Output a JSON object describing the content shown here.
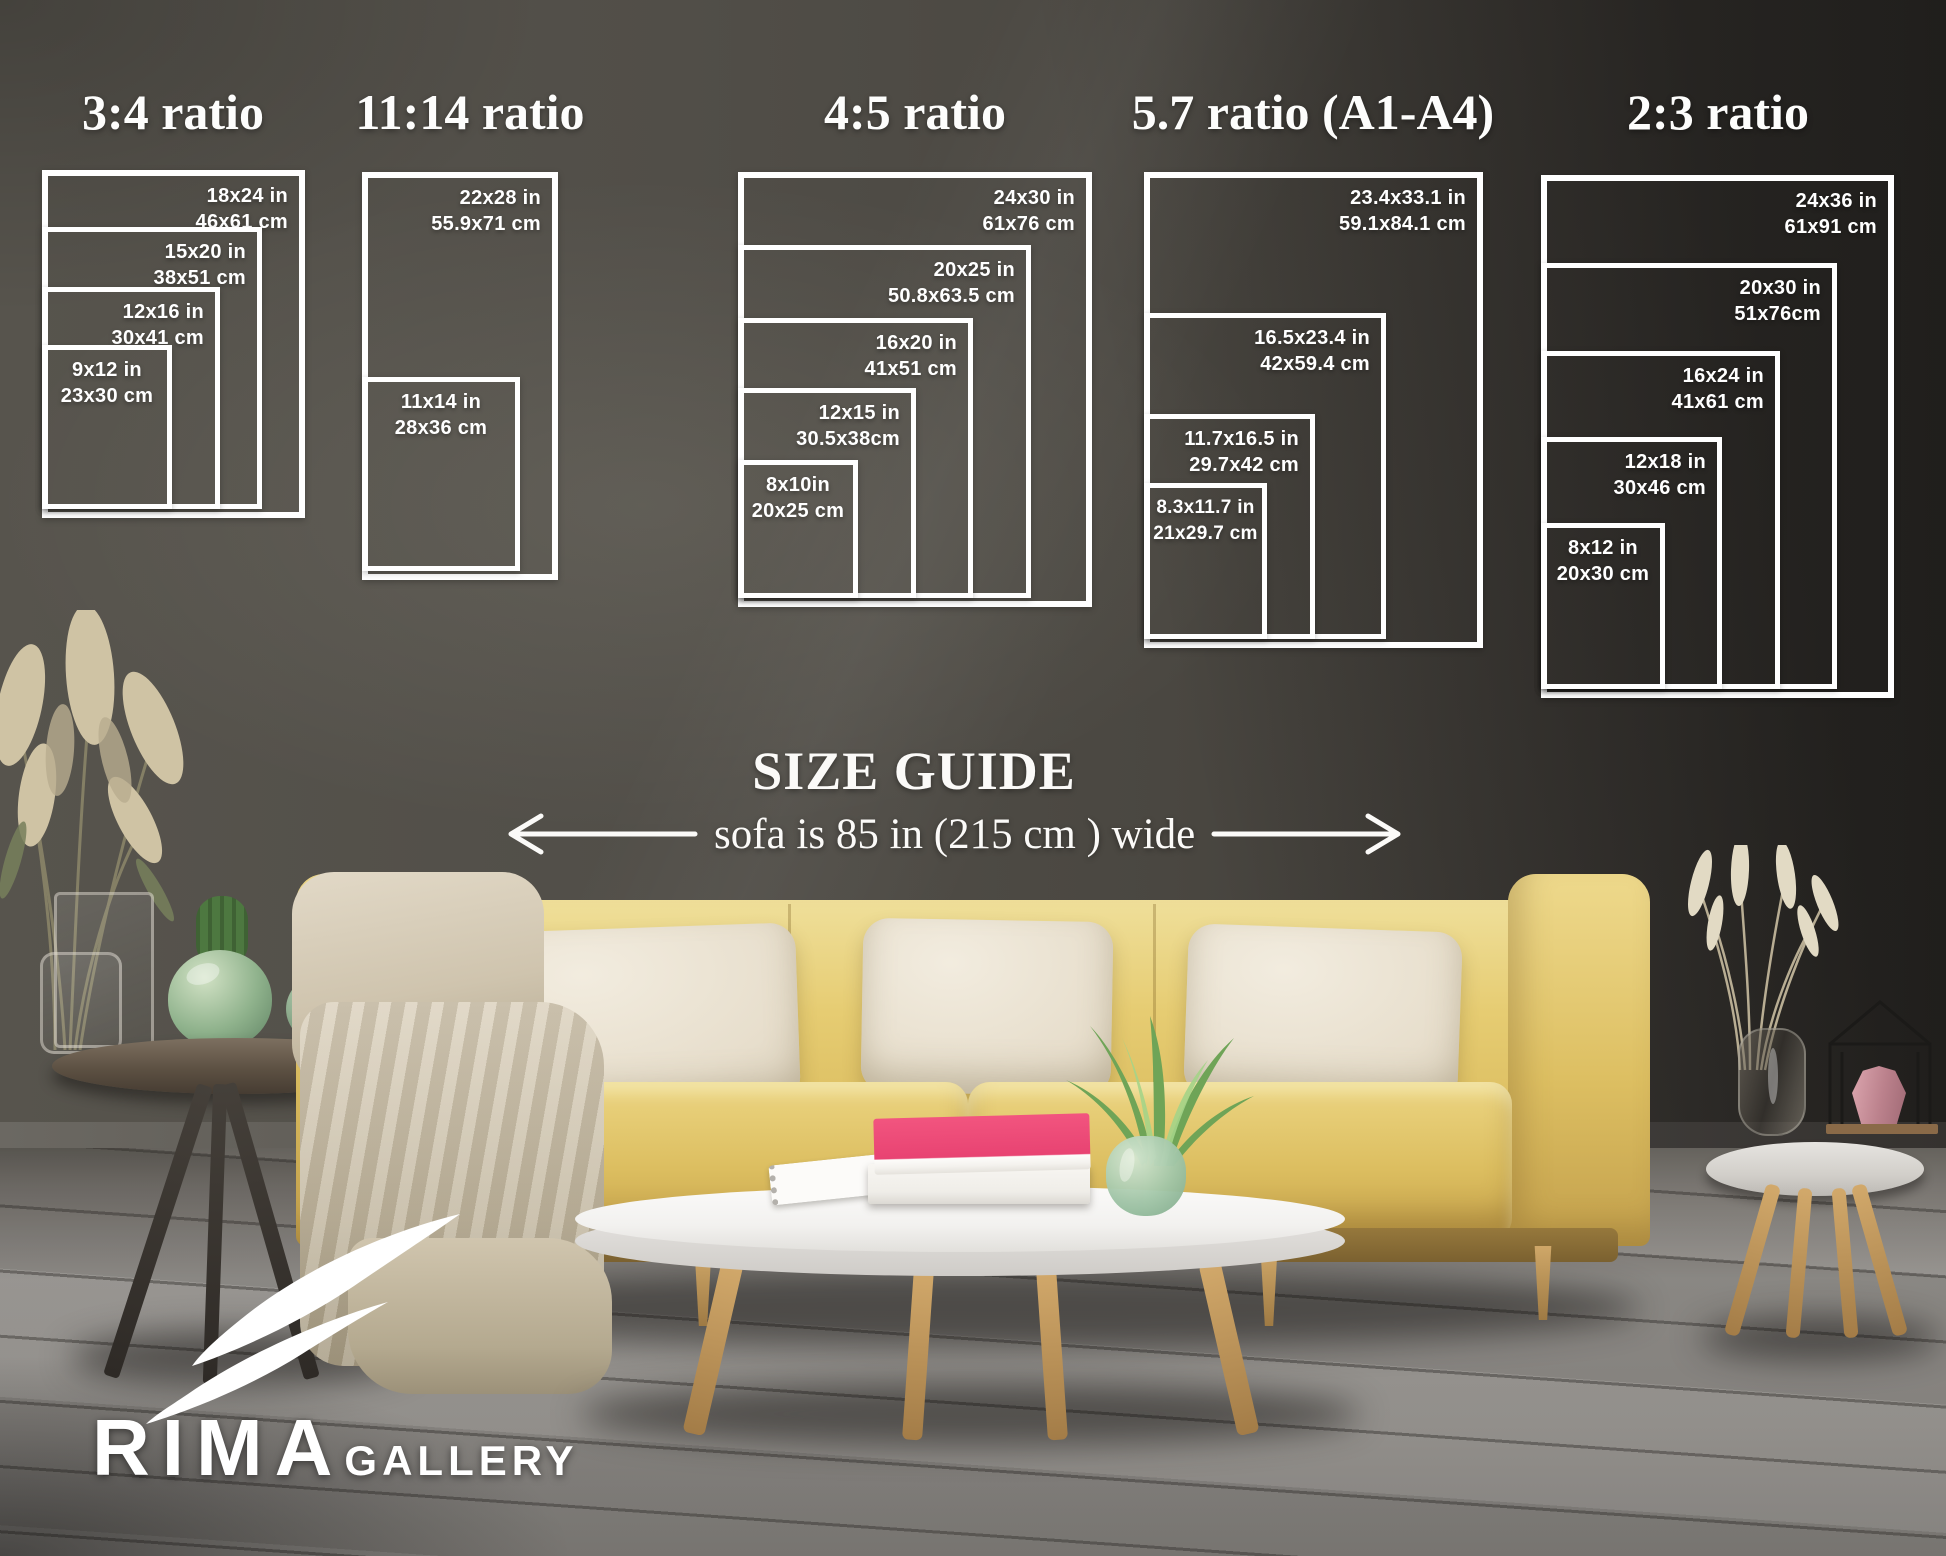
{
  "size_guide": {
    "heading": "SIZE GUIDE",
    "sofa_width_note": "sofa is 85 in (215 cm ) wide",
    "groups": [
      {
        "title": "3:4 ratio",
        "frames": [
          {
            "label_in": "18x24 in",
            "label_cm": "46x61 cm"
          },
          {
            "label_in": "15x20 in",
            "label_cm": "38x51 cm"
          },
          {
            "label_in": "12x16 in",
            "label_cm": "30x41 cm"
          },
          {
            "label_in": "9x12 in",
            "label_cm": "23x30 cm"
          }
        ]
      },
      {
        "title": "11:14 ratio",
        "frames": [
          {
            "label_in": "22x28 in",
            "label_cm": "55.9x71 cm"
          },
          {
            "label_in": "11x14 in",
            "label_cm": "28x36 cm"
          }
        ]
      },
      {
        "title": "4:5 ratio",
        "frames": [
          {
            "label_in": "24x30 in",
            "label_cm": "61x76 cm"
          },
          {
            "label_in": "20x25 in",
            "label_cm": "50.8x63.5 cm"
          },
          {
            "label_in": "16x20 in",
            "label_cm": "41x51 cm"
          },
          {
            "label_in": "12x15 in",
            "label_cm": "30.5x38cm"
          },
          {
            "label_in": "8x10in",
            "label_cm": "20x25 cm"
          }
        ]
      },
      {
        "title": "5.7 ratio (A1-A4)",
        "frames": [
          {
            "label_in": "23.4x33.1 in",
            "label_cm": "59.1x84.1 cm"
          },
          {
            "label_in": "16.5x23.4 in",
            "label_cm": "42x59.4 cm"
          },
          {
            "label_in": "11.7x16.5 in",
            "label_cm": "29.7x42 cm"
          },
          {
            "label_in": "8.3x11.7 in",
            "label_cm": "21x29.7 cm"
          }
        ]
      },
      {
        "title": "2:3 ratio",
        "frames": [
          {
            "label_in": "24x36 in",
            "label_cm": "61x91 cm"
          },
          {
            "label_in": "20x30 in",
            "label_cm": "51x76cm"
          },
          {
            "label_in": "16x24 in",
            "label_cm": "41x61 cm"
          },
          {
            "label_in": "12x18 in",
            "label_cm": "30x46 cm"
          },
          {
            "label_in": "8x12 in",
            "label_cm": "20x30 cm"
          }
        ]
      }
    ]
  },
  "brand": {
    "name_primary": "RIMA",
    "name_secondary": "GALLERY"
  },
  "palette": {
    "frame_white": "#ffffff",
    "wall_gray": "#4c4944",
    "floor_gray": "#8b8884",
    "sofa_yellow": "#e2c565",
    "pillow_cream": "#eae3d4",
    "book_pink": "#ee4a7c",
    "plant_green": "#7fae63"
  }
}
